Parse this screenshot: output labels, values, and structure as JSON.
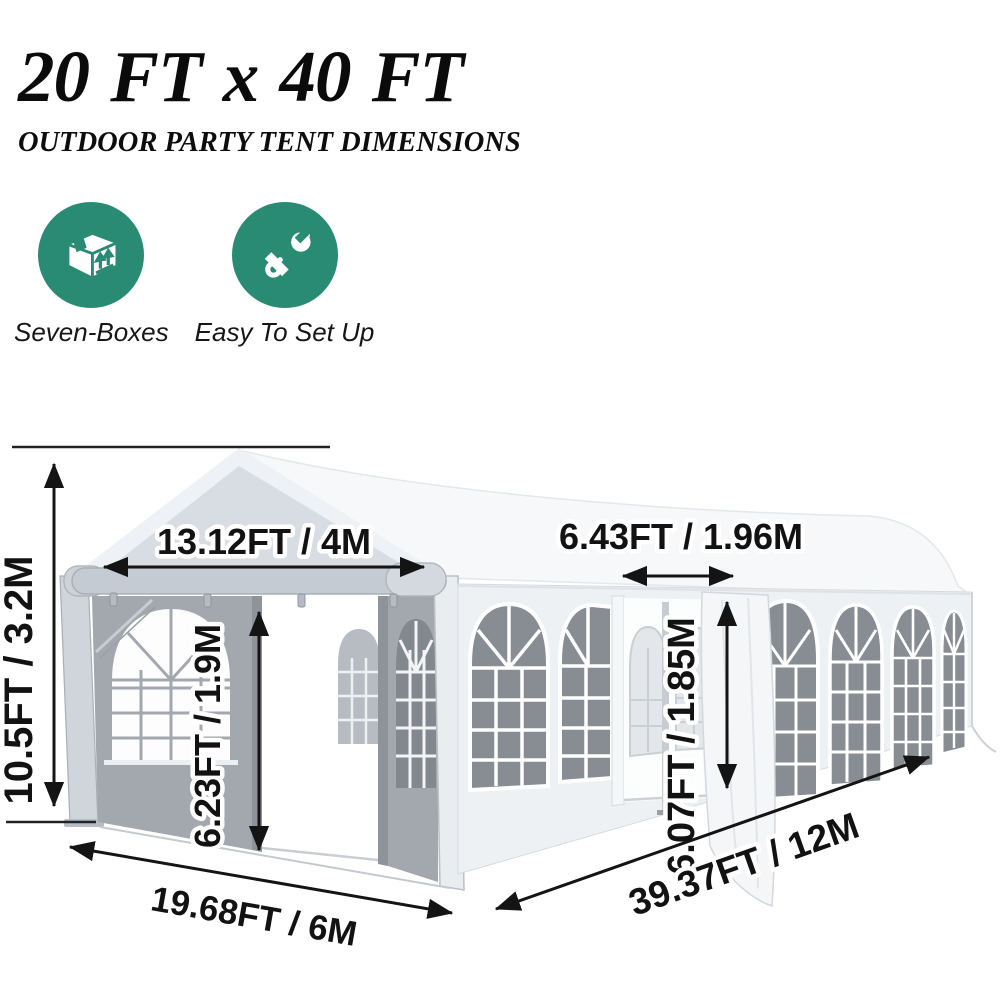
{
  "header": {
    "title": "20 FT x 40 FT",
    "subtitle": "OUTDOOR PARTY TENT DIMENSIONS"
  },
  "features": [
    {
      "icon": "box-icon",
      "label": "Seven-Boxes"
    },
    {
      "icon": "tools-icon",
      "label": "Easy To Set Up"
    }
  ],
  "dims": {
    "height_total": "10.5FT / 3.2M",
    "front_top_width": "13.12FT / 4M",
    "front_door_height": "6.23FT / 1.9M",
    "side_door_width": "6.43FT / 1.96M",
    "side_door_height": "6.07FT / 1.85M",
    "front_ground_width": "19.68FT / 6M",
    "side_length": "39.37FT / 12M"
  },
  "colors": {
    "accent_teal": "#2A8B74",
    "dimension_text": "#121212",
    "tent_panel_grey": "#A2A8AD",
    "window_pane_grey": "#878D93"
  }
}
